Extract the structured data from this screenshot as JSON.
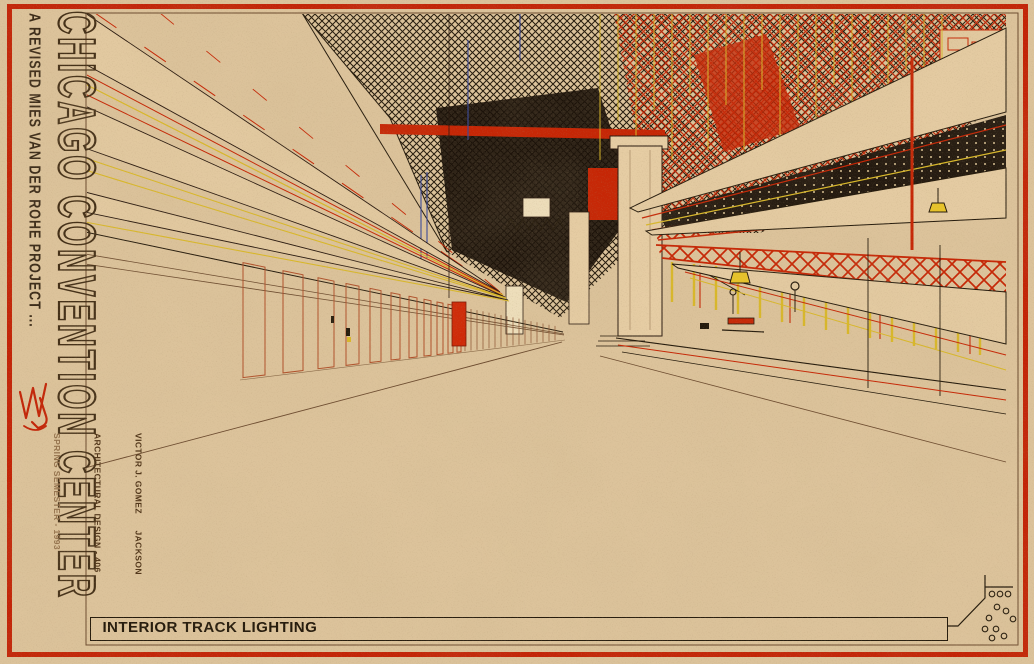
{
  "sheet": {
    "title_vertical": "CHICAGO CONVENTION CENTER",
    "subtitle_vertical": "A REVISED MIES VAN DER ROHE PROJECT ...",
    "signature_monogram": "VJG",
    "credits": {
      "line1": "VICTOR J. GOMEZ      JACKSON",
      "line2": "ARCHITECTURAL DESIGN - 406",
      "line3": "SPRING SEMESTER - 1993"
    },
    "title_block": {
      "drawing_title": "INTERIOR TRACK LIGHTING"
    },
    "palette": {
      "paper": "#dcc39b",
      "border_red": "#c32407",
      "ink_black": "#241a0c",
      "line_brown": "#6b4a2e",
      "accent_red": "#c62605",
      "accent_yellow": "#d9b829",
      "accent_blue": "#3a4a9a",
      "door_outline": "#b0502a"
    }
  }
}
